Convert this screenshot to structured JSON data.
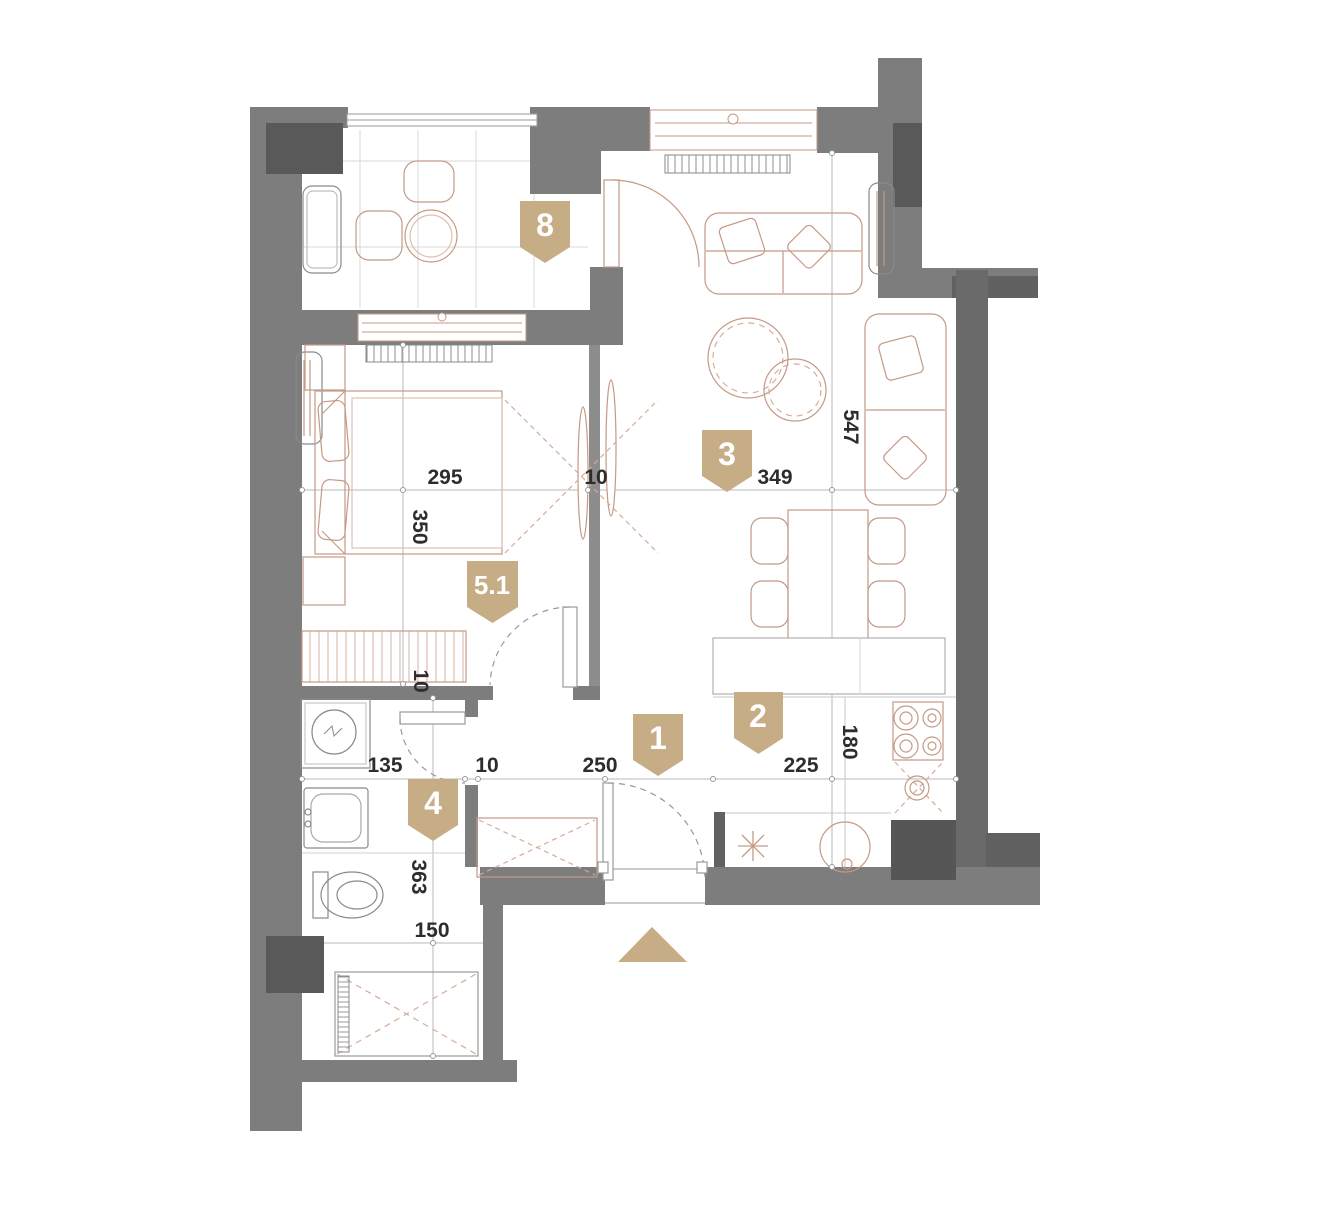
{
  "plan": {
    "type": "apartment-floor-plan",
    "badges": [
      {
        "id": "badge-8",
        "label": "8"
      },
      {
        "id": "badge-3",
        "label": "3"
      },
      {
        "id": "badge-5-1",
        "label": "5.1"
      },
      {
        "id": "badge-1",
        "label": "1"
      },
      {
        "id": "badge-2",
        "label": "2"
      },
      {
        "id": "badge-4",
        "label": "4"
      }
    ],
    "dimensions": {
      "bedroom_width": "295",
      "partition_thickness": "10",
      "living_width": "349",
      "living_height": "547",
      "bedroom_height": "350",
      "wardrobe_depth": "10",
      "bath_width": "135",
      "hall_wall": "10",
      "hall_width": "250",
      "kitchen_width": "225",
      "kitchen_counter": "180",
      "bath_length": "363",
      "shower_width": "150"
    },
    "colors": {
      "accent": "#c6ad86",
      "wall": "#7d7d7d",
      "wall_dark": "#595959",
      "wall_mid": "#6a6a6a",
      "furniture": "#c49a85",
      "furniture_dash": "#d8ab9a",
      "gray_fixture": "#8a8a8a",
      "dim_line": "#b3b3b3",
      "dim_text": "#2d2d2d"
    }
  }
}
